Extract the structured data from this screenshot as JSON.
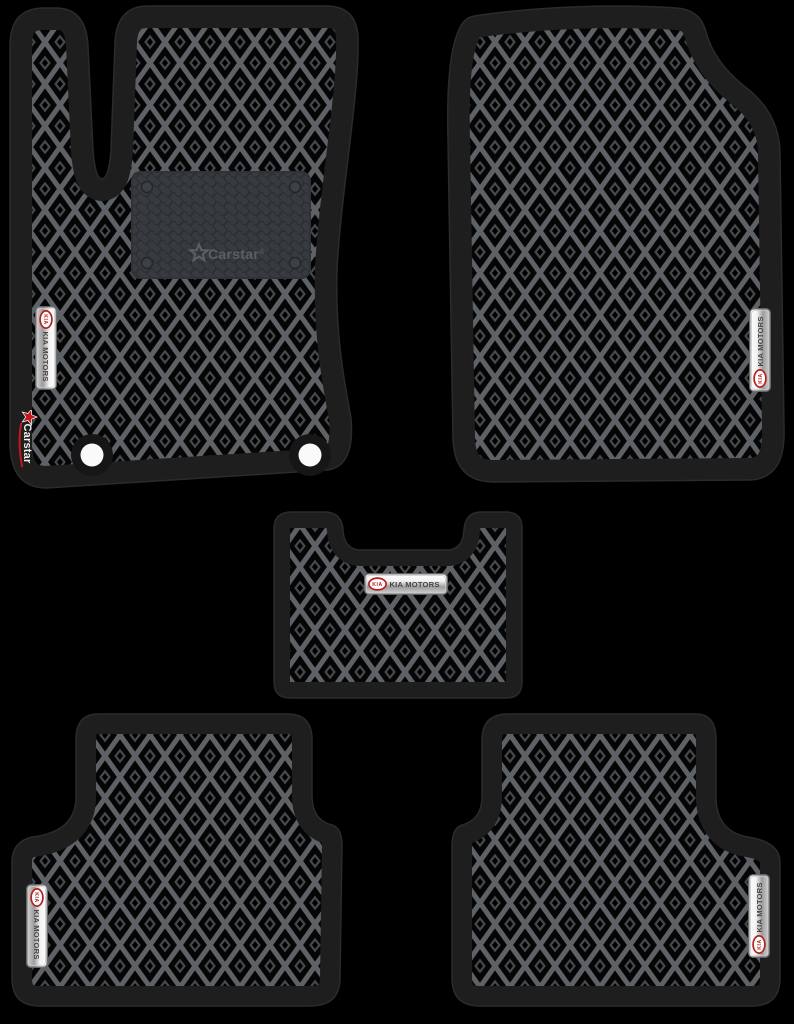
{
  "branding": {
    "heel_pad_logo": "Carstar",
    "registered_mark": "®",
    "side_logo": "Carstar",
    "kia_oval_text": "KIA",
    "kia_badge_text": "KIA MOTORS"
  },
  "colors": {
    "background": "#000000",
    "mat_edging": "#1e1e1e",
    "pattern_lattice": "#5e6266",
    "pattern_cell": "#050505",
    "heel_pad": "#373a3e",
    "kia_red": "#b2221f",
    "carstar_red": "#c4161c",
    "badge_silver": "#e8e8e8",
    "fixing_hole": "#fafafa"
  }
}
